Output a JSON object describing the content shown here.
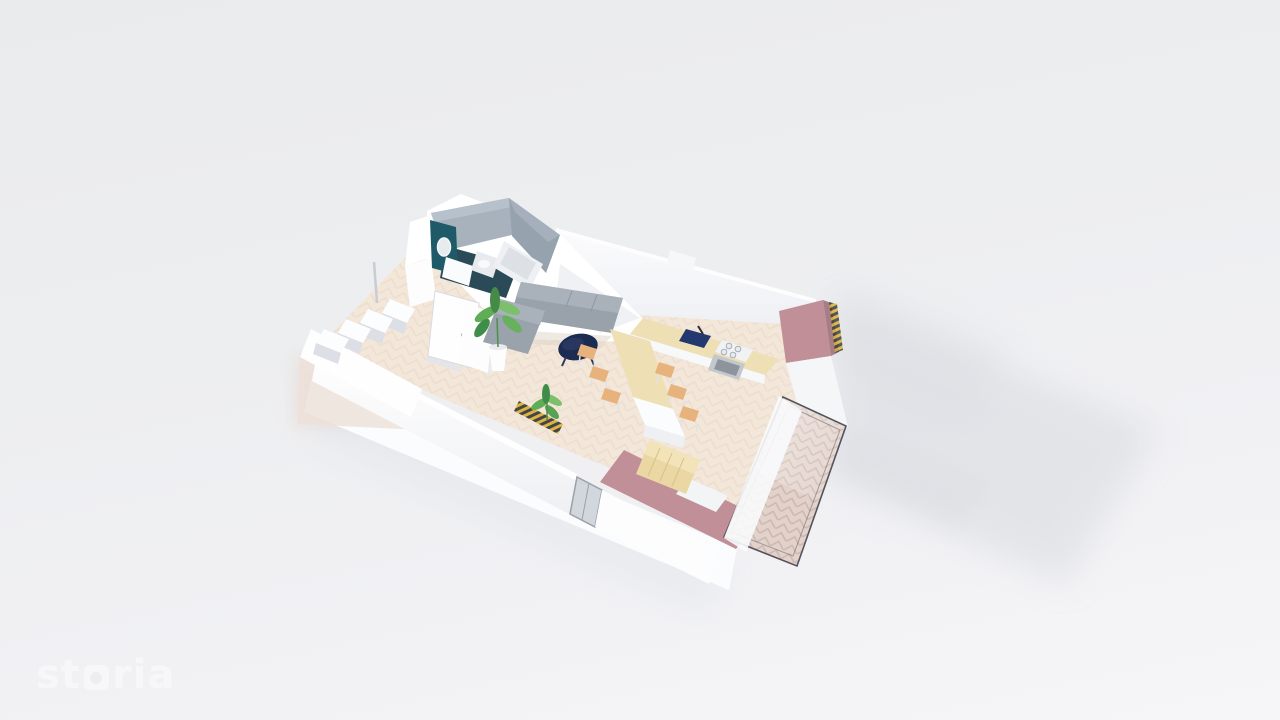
{
  "watermark": {
    "brand": "storia",
    "prefix": "st",
    "suffix": "ria"
  },
  "colors": {
    "background_top": "#eaebed",
    "background_bottom": "#f6f6f8",
    "shadow_soft": "#d6d8de",
    "wall_white": "#ffffff",
    "wall_shade": "#e9ebf0",
    "floor_wood": "#f3e7da",
    "balcony_floor": "#e2d2cb",
    "accent_pink": "#c18f97",
    "accent_pink_dark": "#a87e86",
    "accent_teal": "#1f5a68",
    "tile_gray": "#a7b2bd",
    "tile_gray_dark": "#96a2ae",
    "sofa_gray": "#99a1aa",
    "sofa_gray_light": "#a9b1ba",
    "table_wood": "#eedfb4",
    "bench_wood": "#ead7a4",
    "chair_tan": "#e7b27c",
    "navy": "#1c2b52",
    "sink_navy": "#22386f",
    "plant_green": "#5fae57",
    "plant_green_dark": "#3e8e4a",
    "plant_green_light": "#7cc06e",
    "glass_frame": "#54545e",
    "glass_tint": "#c8cdd5",
    "hatch_yellow": "#d9b13d",
    "hatch_black": "#3c3c3c",
    "logo_white": "#f7f7f9"
  },
  "scene": {
    "type": "3d-floorplan-render",
    "view": "axonometric dollhouse cutaway of a studio apartment on light gray backdrop",
    "objects": [
      "bathroom",
      "round-mirror",
      "washbasin",
      "toilet",
      "bathtub",
      "entry-door",
      "wardrobe",
      "staircase",
      "balustrade-wall",
      "sofa",
      "coffee-table",
      "potted-plant-large",
      "potted-plant-small",
      "dining-table",
      "dining-chairs",
      "kitchen-counter",
      "kitchen-sink",
      "cooktop",
      "oven",
      "bench-bed",
      "pink-accent-walls",
      "glass-balcony",
      "herringbone-floor",
      "section-hatch-strips",
      "cast-shadow"
    ]
  }
}
